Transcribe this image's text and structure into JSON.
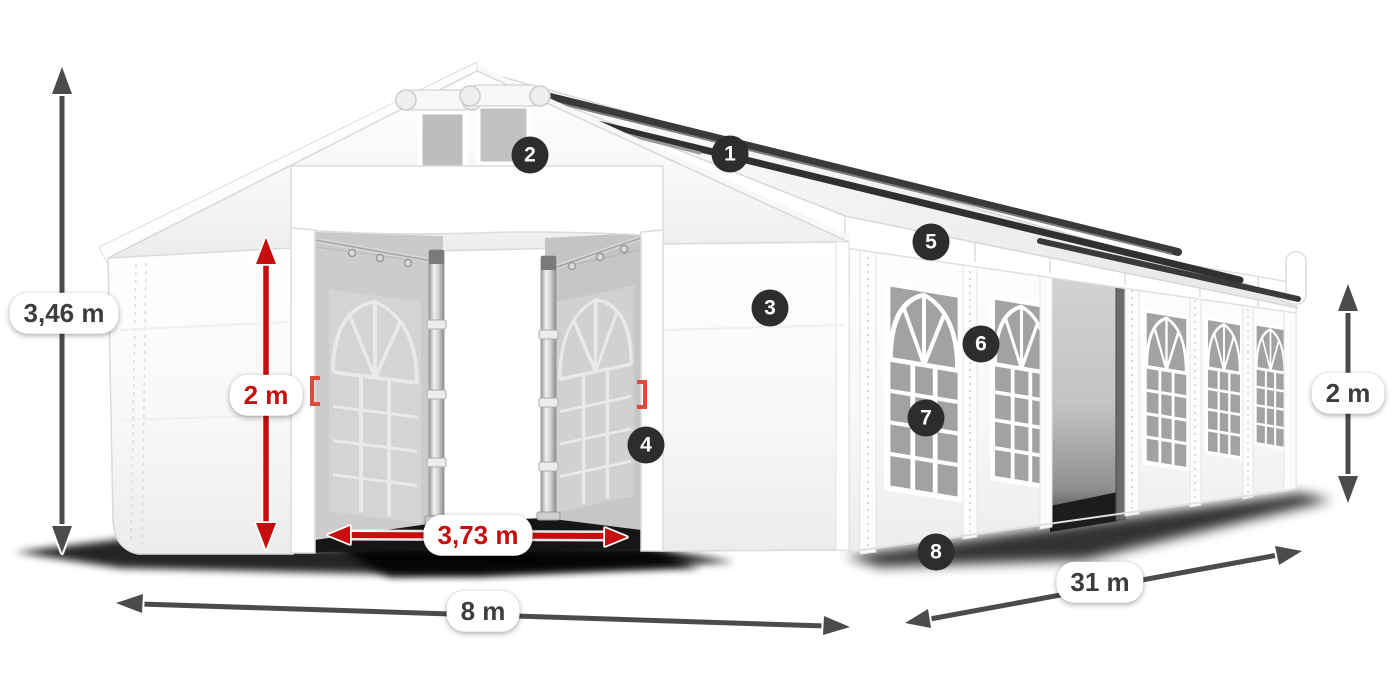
{
  "diagram_title": "Marquee tent dimensions diagram",
  "dimensions": {
    "total_height": "3,46 m",
    "door_height": "2 m",
    "door_width": "3,73 m",
    "front_width": "8 m",
    "side_length": "31 m",
    "side_height": "2 m"
  },
  "badges": [
    {
      "number": "1"
    },
    {
      "number": "2"
    },
    {
      "number": "3"
    },
    {
      "number": "4"
    },
    {
      "number": "5"
    },
    {
      "number": "6"
    },
    {
      "number": "7"
    },
    {
      "number": "8"
    }
  ],
  "colors": {
    "accent_red": "#c60e0e",
    "arrow_gray": "#4b4b4b",
    "badge_bg": "#2d2d2d"
  }
}
